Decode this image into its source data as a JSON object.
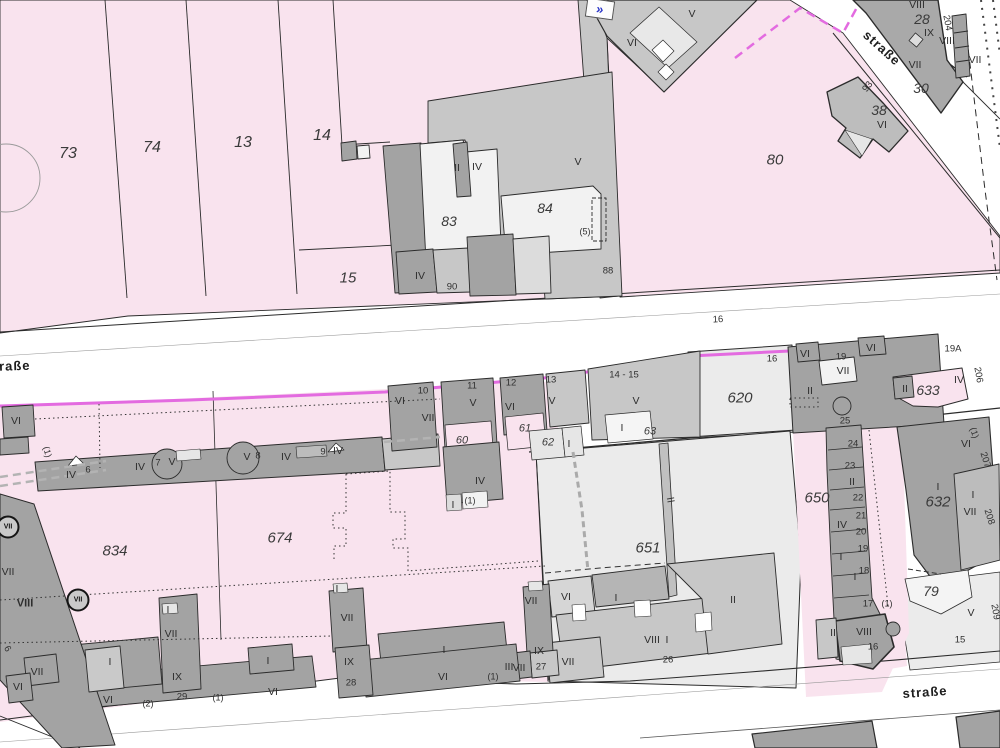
{
  "map": {
    "streets": [
      {
        "t": "straße",
        "x": 8,
        "y": 366,
        "r": -2
      },
      {
        "t": "straße",
        "x": 882,
        "y": 48,
        "r": 42
      },
      {
        "t": "straße",
        "x": 925,
        "y": 692,
        "r": -4
      }
    ],
    "parcels": [
      {
        "t": "73",
        "x": 68,
        "y": 154,
        "s": 16
      },
      {
        "t": "74",
        "x": 152,
        "y": 148,
        "s": 16
      },
      {
        "t": "13",
        "x": 243,
        "y": 143,
        "s": 16
      },
      {
        "t": "14",
        "x": 322,
        "y": 136,
        "s": 16
      },
      {
        "t": "15",
        "x": 348,
        "y": 278,
        "s": 15
      },
      {
        "t": "80",
        "x": 775,
        "y": 160,
        "s": 15
      },
      {
        "t": "28",
        "x": 922,
        "y": 19,
        "s": 14
      },
      {
        "t": "30",
        "x": 921,
        "y": 88,
        "s": 14
      },
      {
        "t": "38",
        "x": 879,
        "y": 110,
        "s": 14
      },
      {
        "t": "83",
        "x": 449,
        "y": 221,
        "s": 14
      },
      {
        "t": "84",
        "x": 545,
        "y": 208,
        "s": 14
      },
      {
        "t": "620",
        "x": 740,
        "y": 398,
        "s": 15
      },
      {
        "t": "633",
        "x": 928,
        "y": 390,
        "s": 14
      },
      {
        "t": "650",
        "x": 817,
        "y": 498,
        "s": 15
      },
      {
        "t": "651",
        "x": 648,
        "y": 548,
        "s": 15
      },
      {
        "t": "632",
        "x": 938,
        "y": 502,
        "s": 15
      },
      {
        "t": "674",
        "x": 280,
        "y": 538,
        "s": 15
      },
      {
        "t": "834",
        "x": 115,
        "y": 551,
        "s": 15
      },
      {
        "t": "79",
        "x": 931,
        "y": 591,
        "s": 14
      },
      {
        "t": "60",
        "x": 462,
        "y": 441,
        "s": 11
      },
      {
        "t": "61",
        "x": 525,
        "y": 429,
        "s": 11
      },
      {
        "t": "62",
        "x": 548,
        "y": 443,
        "s": 11
      },
      {
        "t": "63",
        "x": 650,
        "y": 432,
        "s": 11
      }
    ],
    "houses": [
      {
        "t": "6",
        "x": 88,
        "y": 470
      },
      {
        "t": "7",
        "x": 158,
        "y": 463
      },
      {
        "t": "8",
        "x": 258,
        "y": 456
      },
      {
        "t": "9",
        "x": 323,
        "y": 452
      },
      {
        "t": "10",
        "x": 423,
        "y": 391
      },
      {
        "t": "11",
        "x": 472,
        "y": 386
      },
      {
        "t": "12",
        "x": 511,
        "y": 383
      },
      {
        "t": "13",
        "x": 551,
        "y": 380
      },
      {
        "t": "14 - 15",
        "x": 624,
        "y": 375
      },
      {
        "t": "16",
        "x": 718,
        "y": 320,
        "r": -3
      },
      {
        "t": "16",
        "x": 772,
        "y": 359
      },
      {
        "t": "19",
        "x": 841,
        "y": 357
      },
      {
        "t": "19A",
        "x": 953,
        "y": 349
      },
      {
        "t": "25",
        "x": 845,
        "y": 421
      },
      {
        "t": "24",
        "x": 853,
        "y": 444
      },
      {
        "t": "23",
        "x": 850,
        "y": 466
      },
      {
        "t": "22",
        "x": 858,
        "y": 498
      },
      {
        "t": "21",
        "x": 861,
        "y": 516
      },
      {
        "t": "20",
        "x": 861,
        "y": 532
      },
      {
        "t": "19",
        "x": 863,
        "y": 549
      },
      {
        "t": "18",
        "x": 864,
        "y": 571
      },
      {
        "t": "17",
        "x": 868,
        "y": 604
      },
      {
        "t": "16",
        "x": 873,
        "y": 647
      },
      {
        "t": "26",
        "x": 668,
        "y": 660
      },
      {
        "t": "27",
        "x": 541,
        "y": 667
      },
      {
        "t": "28",
        "x": 351,
        "y": 683
      },
      {
        "t": "29",
        "x": 182,
        "y": 697
      },
      {
        "t": "88",
        "x": 608,
        "y": 271
      },
      {
        "t": "90",
        "x": 452,
        "y": 287
      },
      {
        "t": "93",
        "x": 868,
        "y": 87,
        "r": -52
      },
      {
        "t": "204",
        "x": 947,
        "y": 23,
        "r": 80
      },
      {
        "t": "206",
        "x": 978,
        "y": 375,
        "r": 80
      },
      {
        "t": "207",
        "x": 985,
        "y": 460,
        "r": 72
      },
      {
        "t": "208",
        "x": 989,
        "y": 517,
        "r": 72
      },
      {
        "t": "209",
        "x": 995,
        "y": 612,
        "r": 80
      },
      {
        "t": "15",
        "x": 960,
        "y": 640
      },
      {
        "t": "6",
        "x": 7,
        "y": 649,
        "r": 60
      }
    ],
    "floors": [
      {
        "t": "VI",
        "x": 632,
        "y": 43
      },
      {
        "t": "V",
        "x": 692,
        "y": 14
      },
      {
        "t": "II",
        "x": 457,
        "y": 168
      },
      {
        "t": "IV",
        "x": 477,
        "y": 167
      },
      {
        "t": "V",
        "x": 578,
        "y": 162
      },
      {
        "t": "IV",
        "x": 420,
        "y": 276
      },
      {
        "t": "VIII",
        "x": 917,
        "y": 5
      },
      {
        "t": "IX",
        "x": 929,
        "y": 33
      },
      {
        "t": "VIII",
        "x": 947,
        "y": 41
      },
      {
        "t": "VII",
        "x": 915,
        "y": 65
      },
      {
        "t": "VII",
        "x": 975,
        "y": 60
      },
      {
        "t": "VI",
        "x": 882,
        "y": 125
      },
      {
        "t": "VI",
        "x": 16,
        "y": 421
      },
      {
        "t": "IV",
        "x": 71,
        "y": 475
      },
      {
        "t": "IV",
        "x": 140,
        "y": 467
      },
      {
        "t": "V",
        "x": 172,
        "y": 462
      },
      {
        "t": "V",
        "x": 247,
        "y": 457
      },
      {
        "t": "IV",
        "x": 286,
        "y": 457
      },
      {
        "t": "IV",
        "x": 338,
        "y": 451
      },
      {
        "t": "VI",
        "x": 400,
        "y": 401
      },
      {
        "t": "VII",
        "x": 428,
        "y": 418
      },
      {
        "t": "V",
        "x": 473,
        "y": 403
      },
      {
        "t": "VI",
        "x": 510,
        "y": 407
      },
      {
        "t": "V",
        "x": 552,
        "y": 401
      },
      {
        "t": "V",
        "x": 636,
        "y": 401
      },
      {
        "t": "I",
        "x": 622,
        "y": 428
      },
      {
        "t": "I",
        "x": 569,
        "y": 444
      },
      {
        "t": "IV",
        "x": 480,
        "y": 481
      },
      {
        "t": "I",
        "x": 453,
        "y": 505
      },
      {
        "t": "VI",
        "x": 805,
        "y": 354
      },
      {
        "t": "VI",
        "x": 871,
        "y": 348
      },
      {
        "t": "VII",
        "x": 843,
        "y": 371
      },
      {
        "t": "II",
        "x": 810,
        "y": 391
      },
      {
        "t": "II",
        "x": 905,
        "y": 389
      },
      {
        "t": "IV",
        "x": 959,
        "y": 380
      },
      {
        "t": "II",
        "x": 852,
        "y": 482
      },
      {
        "t": "IV",
        "x": 842,
        "y": 525
      },
      {
        "t": "I",
        "x": 841,
        "y": 557
      },
      {
        "t": "I",
        "x": 855,
        "y": 577
      },
      {
        "t": "II",
        "x": 670,
        "y": 500,
        "r": 80
      },
      {
        "t": "VI",
        "x": 966,
        "y": 444
      },
      {
        "t": "I",
        "x": 938,
        "y": 487
      },
      {
        "t": "I",
        "x": 973,
        "y": 495
      },
      {
        "t": "VII",
        "x": 970,
        "y": 512
      },
      {
        "t": "VI",
        "x": 566,
        "y": 597
      },
      {
        "t": "I",
        "x": 616,
        "y": 598
      },
      {
        "t": "II",
        "x": 733,
        "y": 600
      },
      {
        "t": "VIII",
        "x": 652,
        "y": 640
      },
      {
        "t": "I",
        "x": 667,
        "y": 640
      },
      {
        "t": "VII",
        "x": 568,
        "y": 662
      },
      {
        "t": "VII",
        "x": 347,
        "y": 618
      },
      {
        "t": "IX",
        "x": 349,
        "y": 662
      },
      {
        "t": "I",
        "x": 444,
        "y": 650
      },
      {
        "t": "VI",
        "x": 443,
        "y": 677
      },
      {
        "t": "III",
        "x": 509,
        "y": 667
      },
      {
        "t": "VII",
        "x": 519,
        "y": 668
      },
      {
        "t": "VII",
        "x": 531,
        "y": 601
      },
      {
        "t": "IX",
        "x": 539,
        "y": 651
      },
      {
        "t": "VII",
        "x": 171,
        "y": 634
      },
      {
        "t": "IX",
        "x": 177,
        "y": 677
      },
      {
        "t": "I",
        "x": 110,
        "y": 662
      },
      {
        "t": "I",
        "x": 268,
        "y": 661
      },
      {
        "t": "VI",
        "x": 108,
        "y": 700
      },
      {
        "t": "VI",
        "x": 273,
        "y": 692
      },
      {
        "t": "VII",
        "x": 8,
        "y": 572
      },
      {
        "t": "VIII",
        "x": 25,
        "y": 604,
        "s": 11,
        "b": 1
      },
      {
        "t": "V",
        "x": 971,
        "y": 613
      },
      {
        "t": "II",
        "x": 833,
        "y": 633
      },
      {
        "t": "VIII",
        "x": 864,
        "y": 632
      },
      {
        "t": "VII",
        "x": 37,
        "y": 672
      },
      {
        "t": "VI",
        "x": 18,
        "y": 687
      },
      {
        "t": "I",
        "x": 168,
        "y": 610
      },
      {
        "t": "I",
        "x": 337,
        "y": 589
      }
    ],
    "annotations": [
      {
        "t": "(1)",
        "x": 470,
        "y": 501
      },
      {
        "t": "(1)",
        "x": 493,
        "y": 677
      },
      {
        "t": "(1)",
        "x": 218,
        "y": 698
      },
      {
        "t": "(1)",
        "x": 887,
        "y": 604
      },
      {
        "t": "(1)",
        "x": 47,
        "y": 452,
        "r": 75
      },
      {
        "t": "(1)",
        "x": 974,
        "y": 433,
        "r": 72
      },
      {
        "t": "(2)",
        "x": 148,
        "y": 704
      },
      {
        "t": "(5)",
        "x": 585,
        "y": 232
      }
    ],
    "emblems": [
      {
        "t": "VII",
        "x": 78,
        "y": 600
      },
      {
        "t": "VII",
        "x": 8,
        "y": 527
      }
    ],
    "chevron": {
      "t": "»",
      "x": 600,
      "y": 9,
      "r": 10
    },
    "colors": {
      "pink": "#f9e3ee",
      "parcel_light": "#ebebeb",
      "building_light": "#f2f2f2",
      "building_mid": "#c7c7c7",
      "building_dark": "#a3a3a3",
      "outline": "#2b2b2b",
      "magenta": "#e36be0",
      "blue": "#2a35c8",
      "text": "#2f2f2f"
    }
  }
}
